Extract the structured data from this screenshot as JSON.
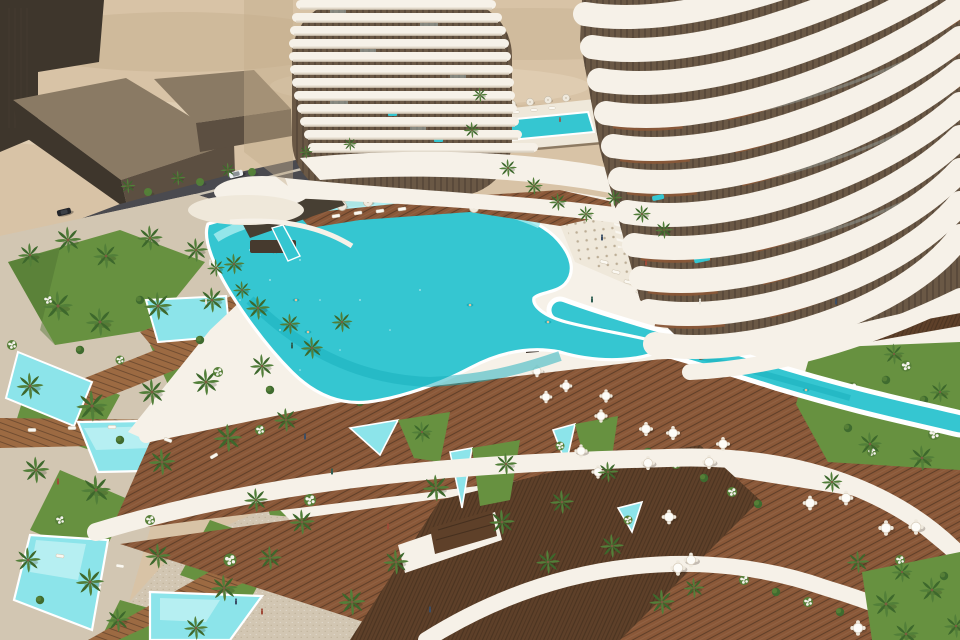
{
  "scene": {
    "description": "Aerial 3D architectural rendering of a luxury desert resort: two curved white towers with stacked wavy balcony bands, a free-form turquoise infinity pool whose channel winds into a landscaped garden river, triangular garden pools, palm trees, wooden restaurant terraces with round dining tables, perimeter roads with cars, and desert sand dunes behind.",
    "setting": "daytime, clear desert light",
    "inventory": {
      "curved_towers": 2,
      "neighbor_buildings": 3,
      "main_freeform_pool": 1,
      "infinity_river_channel": 1,
      "rooftop_lap_pool": 1,
      "garden_pools": 10,
      "balcony_pools": 8,
      "palm_trees": 64,
      "dining_tables": 20,
      "parasols": 10,
      "sun_loungers": 21,
      "people_visible": 22,
      "cars": 2,
      "roads": 2,
      "gated_entrance": 1,
      "slatted_fences": 3
    }
  },
  "palette": {
    "sand": "#d8c3a6",
    "sandLight": "#e6d6bc",
    "sandShadow": "#c4ac8c",
    "blockTop": "#8a7a64",
    "blockFace": "#5c4f41",
    "blockDark": "#3e362c",
    "road": "#4a4a4f",
    "roadDark": "#3f3f44",
    "curb": "#d9d0bf",
    "stone": "#d2c6b2",
    "stoneDot": "#b7a88f",
    "white": "#f6f1e8",
    "cream": "#efe8da",
    "creamShadow": "#d9cfbe",
    "towerGap": "#6a5845",
    "towerGapDark": "#483c2f",
    "glass": "#a9bcbe",
    "poolMain": "#35c6d1",
    "poolDeep": "#18aebc",
    "poolPale": "#a5ebee",
    "poolSmall": "#8ce4ea",
    "poolSmallPale": "#c8f3f5",
    "lawn": "#679140",
    "lawnDark": "#4e7130",
    "frond": "#527f39",
    "frondDark": "#3d682c",
    "shrub": "#3f6b2f",
    "shrubLight": "#567f37",
    "trunk": "#7a5c40",
    "woodLight": "#9c6a42",
    "woodMid": "#8a5838",
    "woodDark": "#5e4029",
    "woodLine": "#46301f",
    "fence": "#473f33",
    "flower": "#f4f2ec",
    "table": "#fdfcf8",
    "chair": "#efe9dd",
    "carDark": "#23252a",
    "carWhite": "#eef0f2",
    "person1": "#3a4d66",
    "person2": "#a04a38",
    "person3": "#e8e4da",
    "person4": "#2e5e52",
    "skin": "#e6c29a"
  }
}
